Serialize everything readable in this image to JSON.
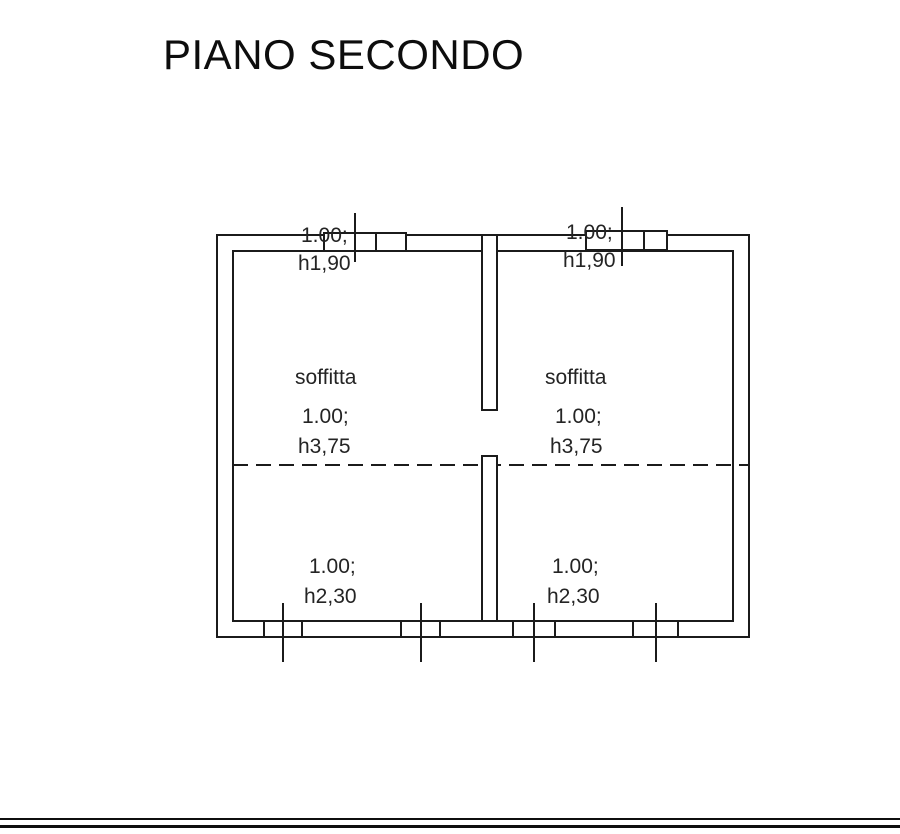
{
  "title": "PIANO SECONDO",
  "plan": {
    "rooms": [
      {
        "name": "soffitta",
        "top_opening": {
          "width": "1.00;",
          "height": "h1,90"
        },
        "center": {
          "width": "1.00;",
          "height": "h3,75"
        },
        "bottom_opening": {
          "width": "1.00;",
          "height": "h2,30"
        }
      },
      {
        "name": "soffitta",
        "top_opening": {
          "width": "1.00;",
          "height": "h1,90"
        },
        "center": {
          "width": "1.00;",
          "height": "h3,75"
        },
        "bottom_opening": {
          "width": "1.00;",
          "height": "h2,30"
        }
      }
    ]
  },
  "colors": {
    "line": "#1b1b1b",
    "text": "#242424",
    "background": "#ffffff"
  }
}
